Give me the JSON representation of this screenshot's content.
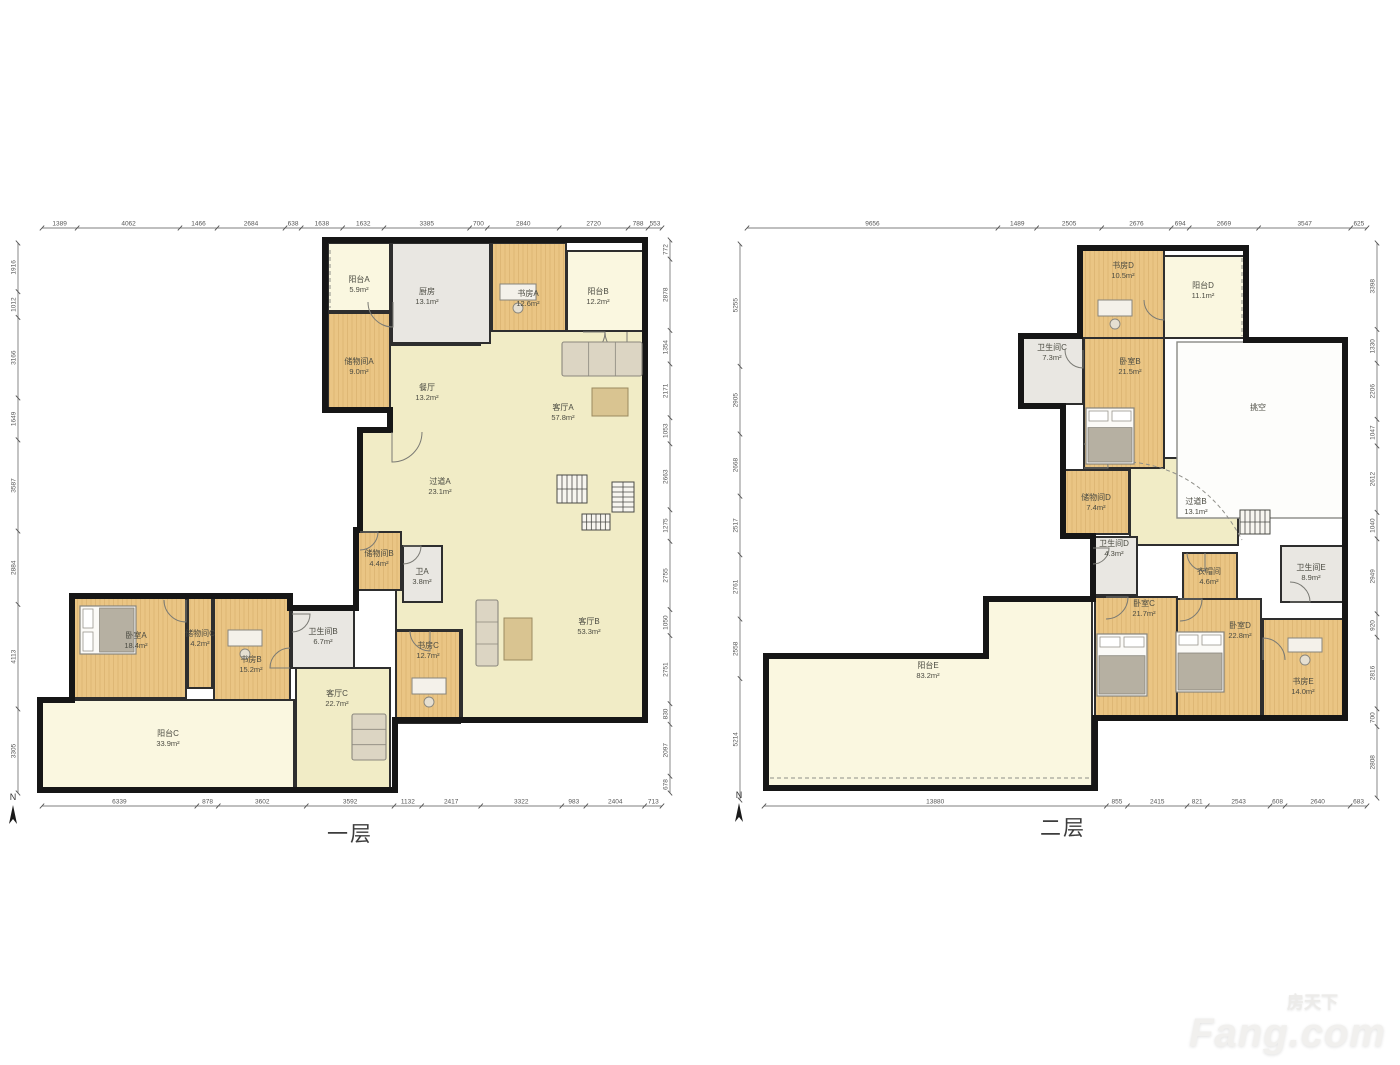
{
  "compass_label": "N",
  "watermark": {
    "cn": "房天下",
    "en": "Fang.com"
  },
  "colors": {
    "wood": "#eac584",
    "living": "#f1ecc6",
    "balcony": "#faf7e0",
    "service": "#e9e7e2",
    "void": "#fdfdfb",
    "wall": "#161616",
    "stroke": "#2e2e2e",
    "dim": "#555555",
    "label": "#4b4b42"
  },
  "floors": [
    {
      "id": "f1",
      "title": "一层",
      "rooms": [
        {
          "id": "f1-yangtai-a",
          "name": "阳台A",
          "area": "5.9m²",
          "type": "balcony"
        },
        {
          "id": "f1-chufang",
          "name": "厨房",
          "area": "13.1m²",
          "type": "service"
        },
        {
          "id": "f1-shufang-a",
          "name": "书房A",
          "area": "12.6m²",
          "type": "wood"
        },
        {
          "id": "f1-yangtai-b",
          "name": "阳台B",
          "area": "12.2m²",
          "type": "balcony"
        },
        {
          "id": "f1-chuwujian-a",
          "name": "储物间A",
          "area": "9.0m²",
          "type": "wood"
        },
        {
          "id": "f1-canting",
          "name": "餐厅",
          "area": "13.2m²",
          "type": "open"
        },
        {
          "id": "f1-keting-a",
          "name": "客厅A",
          "area": "57.8m²",
          "type": "open"
        },
        {
          "id": "f1-guodao-a",
          "name": "过道A",
          "area": "23.1m²",
          "type": "open"
        },
        {
          "id": "f1-chuwujian-b",
          "name": "储物间B",
          "area": "4.4m²",
          "type": "wood"
        },
        {
          "id": "f1-wei-a",
          "name": "卫A",
          "area": "3.8m²",
          "type": "service"
        },
        {
          "id": "f1-keting-b",
          "name": "客厅B",
          "area": "53.3m²",
          "type": "open"
        },
        {
          "id": "f1-shufang-c",
          "name": "书房C",
          "area": "12.7m²",
          "type": "wood"
        },
        {
          "id": "f1-woshi-a",
          "name": "卧室A",
          "area": "18.4m²",
          "type": "wood"
        },
        {
          "id": "f1-chuwujian-c",
          "name": "储物间C",
          "area": "4.2m²",
          "type": "wood"
        },
        {
          "id": "f1-shufang-b",
          "name": "书房B",
          "area": "15.2m²",
          "type": "wood"
        },
        {
          "id": "f1-weishengjian-b",
          "name": "卫生间B",
          "area": "6.7m²",
          "type": "service"
        },
        {
          "id": "f1-keting-c",
          "name": "客厅C",
          "area": "22.7m²",
          "type": "living"
        },
        {
          "id": "f1-yangtai-c",
          "name": "阳台C",
          "area": "33.9m²",
          "type": "balcony"
        }
      ],
      "dims": {
        "top": [
          "1389",
          "4062",
          "1466",
          "2684",
          "638",
          "1638",
          "1632",
          "3385",
          "700",
          "2840",
          "2720",
          "788",
          "553"
        ],
        "bottom": [
          "6339",
          "878",
          "3602",
          "3592",
          "1132",
          "2417",
          "3322",
          "983",
          "2404",
          "713"
        ],
        "left": [
          "1916",
          "1012",
          "3166",
          "1649",
          "3587",
          "2884",
          "4113",
          "3305"
        ],
        "right": [
          "772",
          "2878",
          "1354",
          "2171",
          "1053",
          "2663",
          "1275",
          "2755",
          "1050",
          "2751",
          "830",
          "2097",
          "678"
        ]
      }
    },
    {
      "id": "f2",
      "title": "二层",
      "rooms": [
        {
          "id": "f2-shufang-d",
          "name": "书房D",
          "area": "10.5m²",
          "type": "wood"
        },
        {
          "id": "f2-yangtai-d",
          "name": "阳台D",
          "area": "11.1m²",
          "type": "balcony"
        },
        {
          "id": "f2-weishengjian-c",
          "name": "卫生间C",
          "area": "7.3m²",
          "type": "service"
        },
        {
          "id": "f2-woshi-b",
          "name": "卧室B",
          "area": "21.5m²",
          "type": "wood"
        },
        {
          "id": "f2-tiaokong",
          "name": "挑空",
          "area": "",
          "type": "void"
        },
        {
          "id": "f2-chuwujian-d",
          "name": "储物间D",
          "area": "7.4m²",
          "type": "wood"
        },
        {
          "id": "f2-guodao-b",
          "name": "过道B",
          "area": "13.1m²",
          "type": "open"
        },
        {
          "id": "f2-weishengjian-d",
          "name": "卫生间D",
          "area": "4.3m²",
          "type": "service"
        },
        {
          "id": "f2-yimaojian",
          "name": "衣帽间",
          "area": "4.6m²",
          "type": "wood"
        },
        {
          "id": "f2-weishengjian-e",
          "name": "卫生间E",
          "area": "8.9m²",
          "type": "service"
        },
        {
          "id": "f2-woshi-c",
          "name": "卧室C",
          "area": "21.7m²",
          "type": "wood"
        },
        {
          "id": "f2-woshi-d",
          "name": "卧室D",
          "area": "22.8m²",
          "type": "wood"
        },
        {
          "id": "f2-shufang-e",
          "name": "书房E",
          "area": "14.0m²",
          "type": "wood"
        },
        {
          "id": "f2-yangtai-e",
          "name": "阳台E",
          "area": "83.2m²",
          "type": "balcony"
        }
      ],
      "dims": {
        "top": [
          "9656",
          "1489",
          "2505",
          "2676",
          "694",
          "2669",
          "3547",
          "625"
        ],
        "bottom": [
          "13880",
          "855",
          "2415",
          "821",
          "2543",
          "608",
          "2640",
          "683"
        ],
        "left": [
          "5255",
          "2905",
          "2668",
          "2517",
          "2761",
          "2558",
          "5214"
        ],
        "right": [
          "3398",
          "1330",
          "2206",
          "1047",
          "2612",
          "1040",
          "2949",
          "920",
          "2816",
          "700",
          "2808"
        ]
      }
    }
  ]
}
